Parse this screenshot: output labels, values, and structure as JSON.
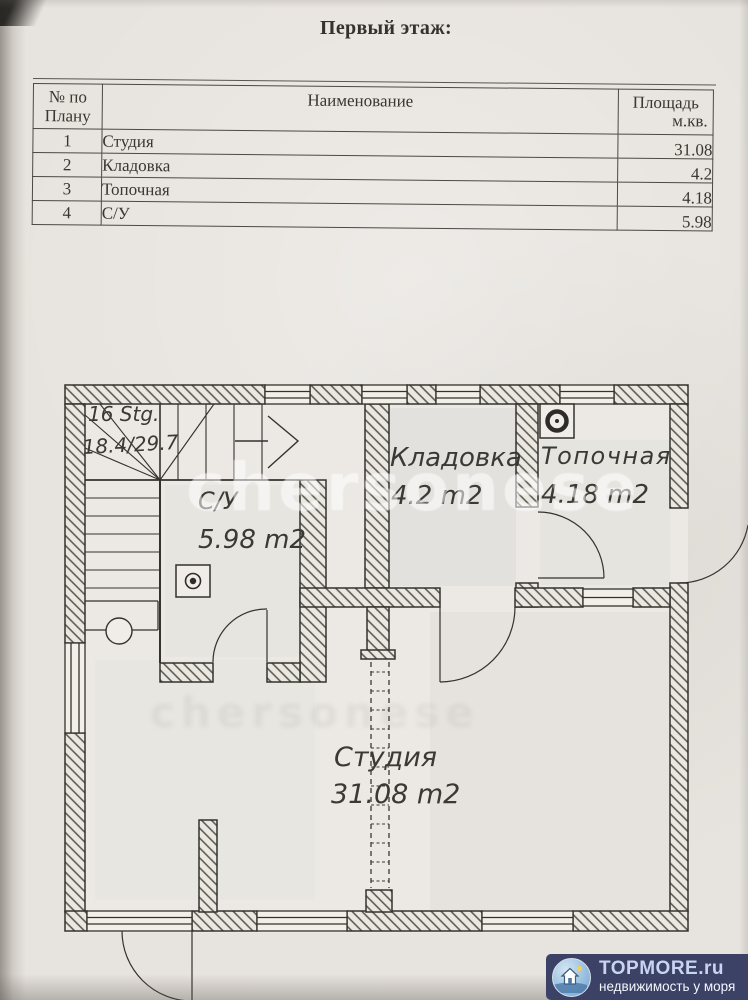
{
  "page": {
    "title": "Первый этаж:"
  },
  "table": {
    "header": {
      "no_line1": "№ по",
      "no_line2": "Плану",
      "name": "Наименование",
      "area_line1": "Площадь",
      "area_line2": "м.кв."
    },
    "rows": [
      {
        "no": "1",
        "name": "Студия",
        "area": "31.08"
      },
      {
        "no": "2",
        "name": "Кладовка",
        "area": "4.2"
      },
      {
        "no": "3",
        "name": "Топочная",
        "area": "4.18"
      },
      {
        "no": "4",
        "name": "С/У",
        "area": "5.98"
      }
    ]
  },
  "plan": {
    "stairs": {
      "line1": "16 Stg.",
      "line2": "18.4/29.7"
    },
    "rooms": {
      "su": {
        "name": "С/У",
        "area": "5.98 m2"
      },
      "kladovka": {
        "name": "Кладовка",
        "area": "4.2 m2"
      },
      "topochnaya": {
        "name": "Топочная",
        "area": "4.18 m2"
      },
      "studio": {
        "name": "Студия",
        "area": "31.08 m2"
      }
    }
  },
  "watermark": "chersonese",
  "logo": {
    "brand": "TOPMORE.ru",
    "tagline": "недвижимость у моря"
  },
  "colors": {
    "logo_bg": "#3c4166",
    "logo_brand": "#c9d4f1",
    "logo_tagline": "#f3f6fc",
    "ink": "#3a3833",
    "paper": "#e7e3de"
  }
}
